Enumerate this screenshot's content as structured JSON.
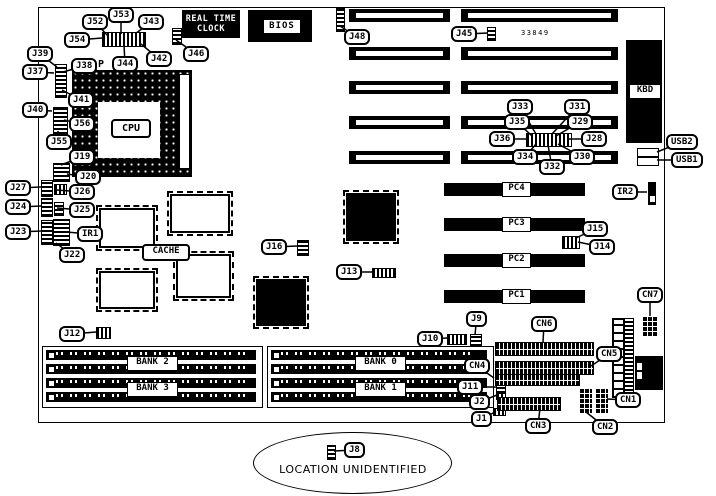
{
  "diagram": {
    "board_number": "33849",
    "socket_mark": "P",
    "location_note": "LOCATION UNIDENTIFIED",
    "cpu_label": "CPU",
    "cache_label": "CACHE",
    "bios_label": "BIOS",
    "rtc_line1": "REAL TIME",
    "rtc_line2": "CLOCK",
    "kbd_label": "KBD",
    "pci_slots": [
      "PC4",
      "PC3",
      "PC2",
      "PC1"
    ],
    "bank_labels": [
      "BANK 2",
      "BANK 3",
      "BANK 0",
      "BANK 1"
    ],
    "callouts": [
      {
        "label": "J52",
        "x": 82,
        "y": 14,
        "tx": 108,
        "ty": 36
      },
      {
        "label": "J53",
        "x": 108,
        "y": 7,
        "tx": 121,
        "ty": 34
      },
      {
        "label": "J43",
        "x": 138,
        "y": 14,
        "tx": 135,
        "ty": 34
      },
      {
        "label": "J54",
        "x": 64,
        "y": 32,
        "tx": 102,
        "ty": 38
      },
      {
        "label": "J44",
        "x": 112,
        "y": 56,
        "tx": 124,
        "ty": 45
      },
      {
        "label": "J42",
        "x": 146,
        "y": 51,
        "tx": 141,
        "ty": 44
      },
      {
        "label": "J46",
        "x": 183,
        "y": 46,
        "tx": 176,
        "ty": 40
      },
      {
        "label": "J39",
        "x": 27,
        "y": 46,
        "tx": 57,
        "ty": 67
      },
      {
        "label": "J37",
        "x": 22,
        "y": 64,
        "tx": 54,
        "ty": 73
      },
      {
        "label": "J38",
        "x": 71,
        "y": 58,
        "tx": 63,
        "ty": 72
      },
      {
        "label": "J41",
        "x": 68,
        "y": 92,
        "tx": 62,
        "ty": 90
      },
      {
        "label": "J40",
        "x": 22,
        "y": 102,
        "tx": 52,
        "ty": 111
      },
      {
        "label": "J56",
        "x": 69,
        "y": 116,
        "tx": 64,
        "ty": 120
      },
      {
        "label": "J55",
        "x": 46,
        "y": 134,
        "tx": 58,
        "ty": 131
      },
      {
        "label": "J19",
        "x": 69,
        "y": 149,
        "tx": 61,
        "ty": 165
      },
      {
        "label": "J20",
        "x": 75,
        "y": 169,
        "tx": 67,
        "ty": 174
      },
      {
        "label": "J27",
        "x": 5,
        "y": 180,
        "tx": 41,
        "ty": 187
      },
      {
        "label": "J26",
        "x": 69,
        "y": 184,
        "tx": 57,
        "ty": 190
      },
      {
        "label": "J24",
        "x": 5,
        "y": 199,
        "tx": 41,
        "ty": 206
      },
      {
        "label": "J25",
        "x": 69,
        "y": 202,
        "tx": 57,
        "ty": 208
      },
      {
        "label": "J23",
        "x": 5,
        "y": 224,
        "tx": 41,
        "ty": 231
      },
      {
        "label": "IR1",
        "x": 77,
        "y": 226,
        "tx": 66,
        "ty": 232
      },
      {
        "label": "J22",
        "x": 59,
        "y": 247,
        "tx": 56,
        "ty": 243
      },
      {
        "label": "J48",
        "x": 344,
        "y": 29,
        "tx": 340,
        "ty": 26
      },
      {
        "label": "J45",
        "x": 451,
        "y": 26,
        "tx": 488,
        "ty": 33
      },
      {
        "label": "J33",
        "x": 507,
        "y": 99,
        "tx": 536,
        "ty": 134
      },
      {
        "label": "J31",
        "x": 564,
        "y": 99,
        "tx": 552,
        "ty": 134
      },
      {
        "label": "J35",
        "x": 504,
        "y": 114,
        "tx": 532,
        "ty": 136
      },
      {
        "label": "J29",
        "x": 567,
        "y": 114,
        "tx": 556,
        "ty": 136
      },
      {
        "label": "J36",
        "x": 489,
        "y": 131,
        "tx": 527,
        "ty": 139
      },
      {
        "label": "J28",
        "x": 581,
        "y": 131,
        "tx": 569,
        "ty": 139
      },
      {
        "label": "J34",
        "x": 512,
        "y": 149,
        "tx": 536,
        "ty": 144
      },
      {
        "label": "J30",
        "x": 569,
        "y": 149,
        "tx": 558,
        "ty": 144
      },
      {
        "label": "J32",
        "x": 539,
        "y": 159,
        "tx": 548,
        "ty": 145
      },
      {
        "label": "USB2",
        "x": 666,
        "y": 134,
        "tx": 657,
        "ty": 152
      },
      {
        "label": "USB1",
        "x": 671,
        "y": 152,
        "tx": 657,
        "ty": 160
      },
      {
        "label": "IR2",
        "x": 612,
        "y": 184,
        "tx": 647,
        "ty": 192
      },
      {
        "label": "J15",
        "x": 582,
        "y": 221,
        "tx": 576,
        "ty": 238
      },
      {
        "label": "J14",
        "x": 589,
        "y": 239,
        "tx": 578,
        "ty": 242
      },
      {
        "label": "J16",
        "x": 261,
        "y": 239,
        "tx": 297,
        "ty": 246
      },
      {
        "label": "J13",
        "x": 336,
        "y": 264,
        "tx": 372,
        "ty": 272
      },
      {
        "label": "CN7",
        "x": 637,
        "y": 287,
        "tx": 650,
        "ty": 316
      },
      {
        "label": "J9",
        "x": 466,
        "y": 311,
        "tx": 475,
        "ty": 335
      },
      {
        "label": "CN6",
        "x": 531,
        "y": 316,
        "tx": 543,
        "ty": 342
      },
      {
        "label": "J10",
        "x": 417,
        "y": 331,
        "tx": 447,
        "ty": 338
      },
      {
        "label": "J12",
        "x": 59,
        "y": 326,
        "tx": 96,
        "ty": 332
      },
      {
        "label": "CN5",
        "x": 596,
        "y": 346,
        "tx": 591,
        "ty": 366
      },
      {
        "label": "CN4",
        "x": 464,
        "y": 358,
        "tx": 494,
        "ty": 378
      },
      {
        "label": "J11",
        "x": 457,
        "y": 379,
        "tx": 496,
        "ty": 387
      },
      {
        "label": "J2",
        "x": 469,
        "y": 394,
        "tx": 497,
        "ty": 395
      },
      {
        "label": "J1",
        "x": 471,
        "y": 411,
        "tx": 495,
        "ty": 412
      },
      {
        "label": "CN3",
        "x": 525,
        "y": 418,
        "tx": 540,
        "ty": 408
      },
      {
        "label": "CN1",
        "x": 615,
        "y": 392,
        "tx": 607,
        "ty": 399
      },
      {
        "label": "CN2",
        "x": 592,
        "y": 419,
        "tx": 586,
        "ty": 412
      },
      {
        "label": "J8",
        "x": 344,
        "y": 442,
        "tx": 334,
        "ty": 451
      }
    ]
  }
}
